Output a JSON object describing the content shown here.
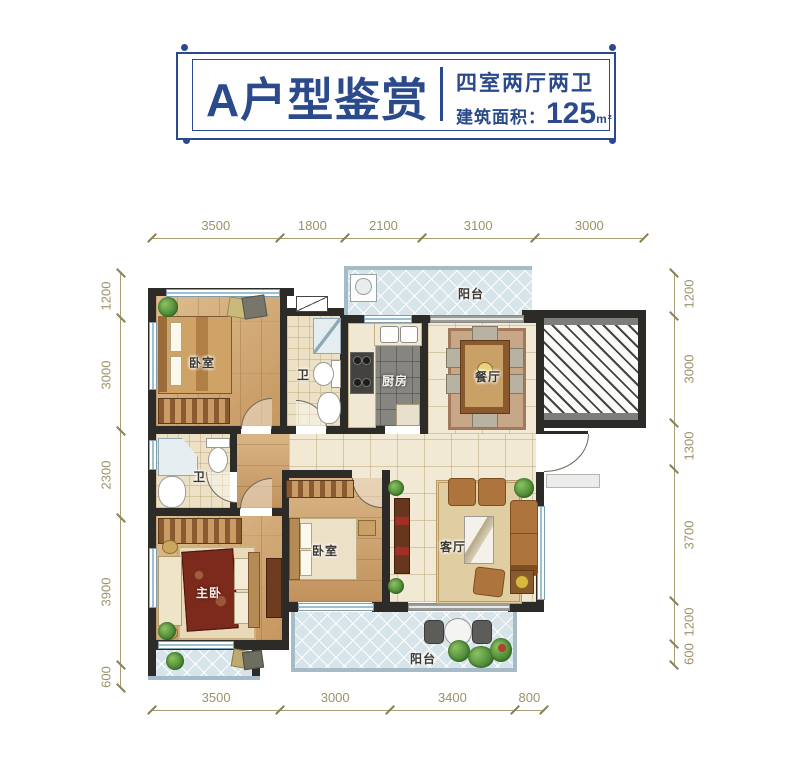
{
  "header": {
    "title": "A户型鉴赏",
    "subtitle": "四室两厅两卫",
    "area_label": "建筑面积：",
    "area_value": "125",
    "area_unit": "m²"
  },
  "dimensions": {
    "top": [
      "3500",
      "1800",
      "2100",
      "3100",
      "3000"
    ],
    "bottom": [
      "3500",
      "3000",
      "3400",
      "800"
    ],
    "left": [
      "1200",
      "3000",
      "2300",
      "3900",
      "600"
    ],
    "right": [
      "1200",
      "3000",
      "1300",
      "3700",
      "1200",
      "600"
    ]
  },
  "rooms": {
    "bedroom_top": "卧室",
    "bath_top": "卫",
    "kitchen": "厨房",
    "balcony_top": "阳台",
    "dining": "餐厅",
    "bath_mid": "卫",
    "master": "主卧",
    "bedroom_bottom": "卧室",
    "living": "客厅",
    "balcony_bottom": "阳台"
  },
  "colors": {
    "brand_navy": "#2b4a8c",
    "dim_olive": "#9c9268",
    "wall_dark": "#2d2b28",
    "wood": "#cfa76f",
    "cream_tile": "#f1e9d4",
    "kitchen_tile": "#878580",
    "bath_tile": "#ece1c4",
    "balcony_blue": "#d7e4e9",
    "master_bed_red": "#7c2a1c"
  }
}
